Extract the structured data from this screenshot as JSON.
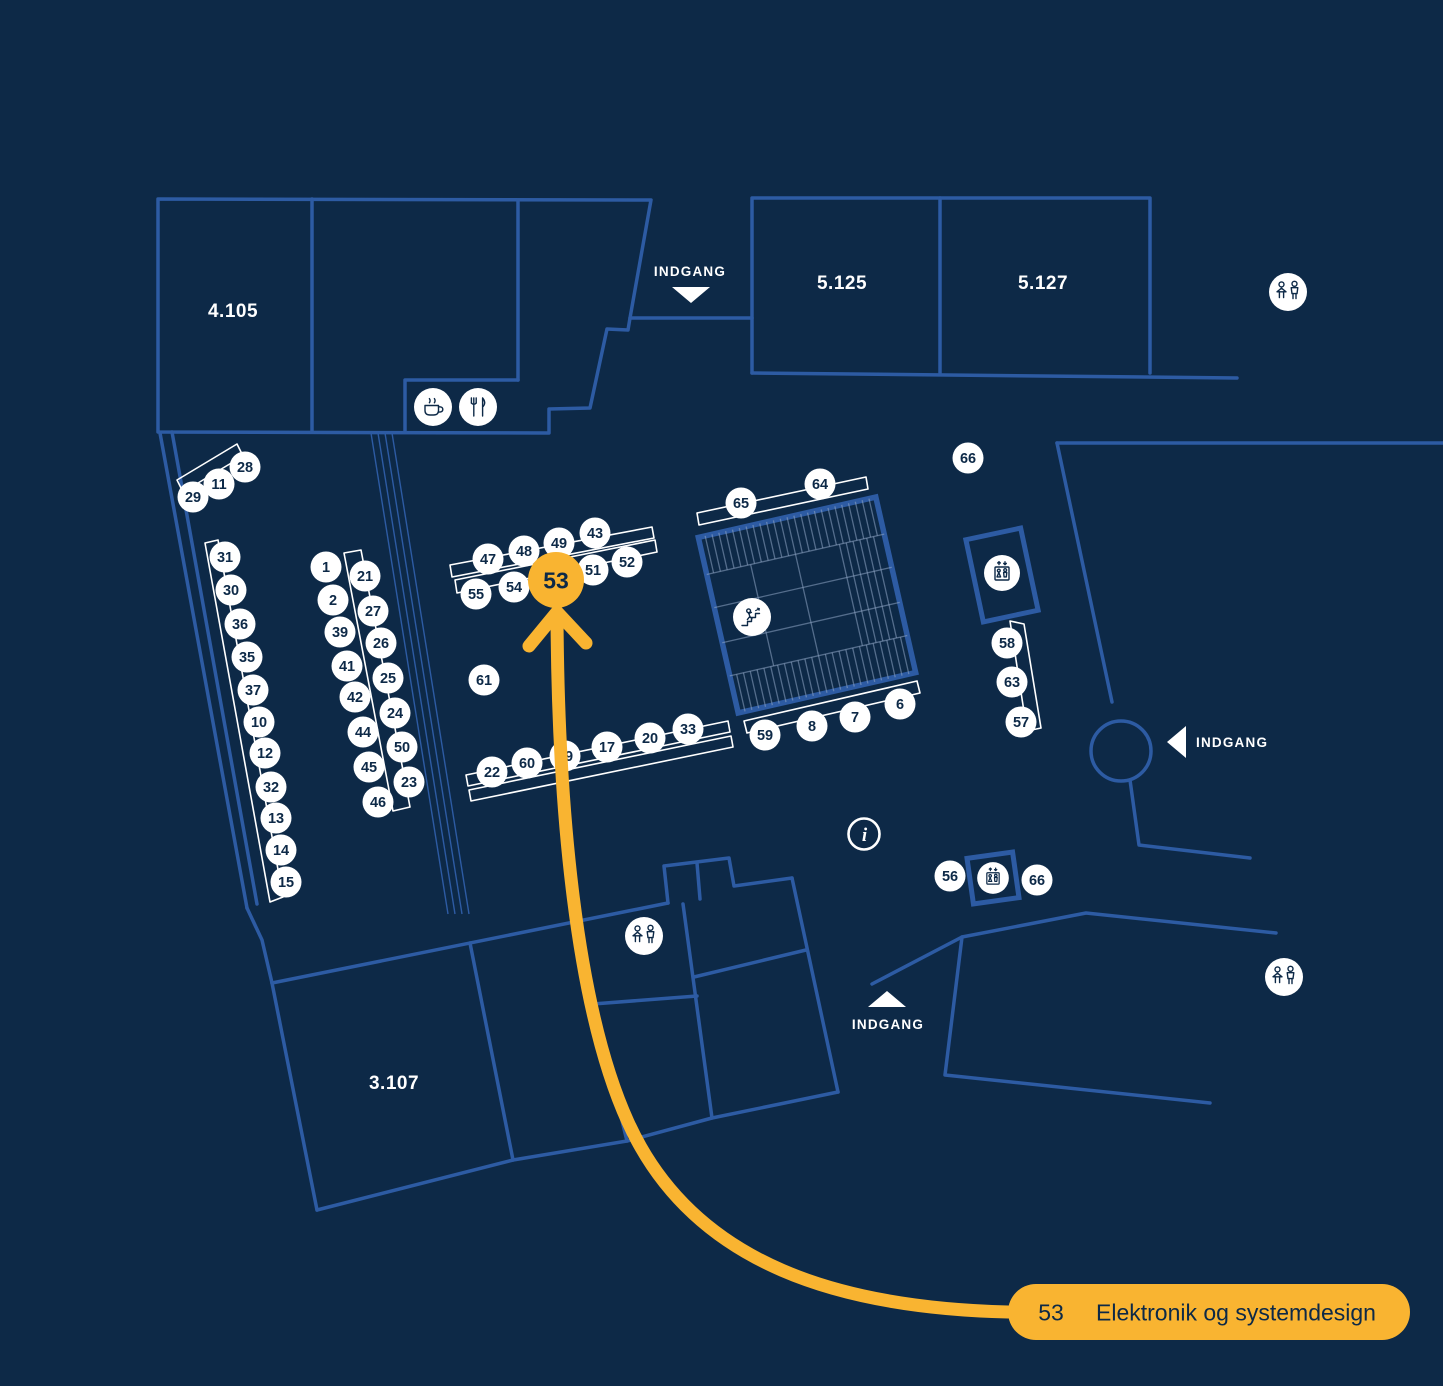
{
  "colors": {
    "background": "#0d2947",
    "line_blue": "#2d5ba3",
    "accent_orange": "#f9b431",
    "white": "#ffffff"
  },
  "legend": {
    "number": "53",
    "name": "Elektronik og systemdesign"
  },
  "highlight": {
    "number": "53",
    "x": 556,
    "y": 580
  },
  "rooms": [
    {
      "label": "4.105",
      "x": 233,
      "y": 310
    },
    {
      "label": "5.125",
      "x": 842,
      "y": 282
    },
    {
      "label": "5.127",
      "x": 1043,
      "y": 282
    },
    {
      "label": "3.107",
      "x": 394,
      "y": 1082
    }
  ],
  "entrances": [
    {
      "label": "INDGANG",
      "dir": "down",
      "tri": {
        "x": 691,
        "y": 295
      },
      "text": {
        "x": 690,
        "y": 271,
        "anchor": "middle"
      }
    },
    {
      "label": "INDGANG",
      "dir": "left",
      "tri": {
        "x": 1177,
        "y": 742
      },
      "text": {
        "x": 1196,
        "y": 742,
        "anchor": "start"
      }
    },
    {
      "label": "INDGANG",
      "dir": "up",
      "tri": {
        "x": 887,
        "y": 999
      },
      "text": {
        "x": 888,
        "y": 1024,
        "anchor": "middle"
      }
    }
  ],
  "markers": [
    {
      "n": "28",
      "x": 245,
      "y": 467
    },
    {
      "n": "11",
      "x": 219,
      "y": 484
    },
    {
      "n": "29",
      "x": 193,
      "y": 497
    },
    {
      "n": "31",
      "x": 225,
      "y": 557
    },
    {
      "n": "30",
      "x": 231,
      "y": 590
    },
    {
      "n": "36",
      "x": 240,
      "y": 624
    },
    {
      "n": "35",
      "x": 247,
      "y": 657
    },
    {
      "n": "37",
      "x": 253,
      "y": 690
    },
    {
      "n": "10",
      "x": 259,
      "y": 722
    },
    {
      "n": "12",
      "x": 265,
      "y": 753
    },
    {
      "n": "32",
      "x": 271,
      "y": 787
    },
    {
      "n": "13",
      "x": 276,
      "y": 818
    },
    {
      "n": "14",
      "x": 281,
      "y": 850
    },
    {
      "n": "15",
      "x": 286,
      "y": 882
    },
    {
      "n": "1",
      "x": 326,
      "y": 567
    },
    {
      "n": "2",
      "x": 333,
      "y": 600
    },
    {
      "n": "39",
      "x": 340,
      "y": 632
    },
    {
      "n": "41",
      "x": 347,
      "y": 666
    },
    {
      "n": "42",
      "x": 355,
      "y": 697
    },
    {
      "n": "44",
      "x": 363,
      "y": 732
    },
    {
      "n": "45",
      "x": 369,
      "y": 767
    },
    {
      "n": "46",
      "x": 378,
      "y": 802
    },
    {
      "n": "21",
      "x": 365,
      "y": 576
    },
    {
      "n": "27",
      "x": 373,
      "y": 611
    },
    {
      "n": "26",
      "x": 381,
      "y": 643
    },
    {
      "n": "25",
      "x": 388,
      "y": 678
    },
    {
      "n": "24",
      "x": 395,
      "y": 713
    },
    {
      "n": "50",
      "x": 402,
      "y": 747
    },
    {
      "n": "23",
      "x": 409,
      "y": 782
    },
    {
      "n": "47",
      "x": 488,
      "y": 559
    },
    {
      "n": "48",
      "x": 524,
      "y": 551
    },
    {
      "n": "49",
      "x": 559,
      "y": 543
    },
    {
      "n": "43",
      "x": 595,
      "y": 533
    },
    {
      "n": "55",
      "x": 476,
      "y": 594
    },
    {
      "n": "54",
      "x": 514,
      "y": 587
    },
    {
      "n": "51",
      "x": 593,
      "y": 570
    },
    {
      "n": "52",
      "x": 627,
      "y": 562
    },
    {
      "n": "65",
      "x": 741,
      "y": 503
    },
    {
      "n": "64",
      "x": 820,
      "y": 484
    },
    {
      "n": "66",
      "x": 968,
      "y": 458
    },
    {
      "n": "61",
      "x": 484,
      "y": 680
    },
    {
      "n": "22",
      "x": 492,
      "y": 772
    },
    {
      "n": "60",
      "x": 527,
      "y": 763
    },
    {
      "n": "19",
      "x": 565,
      "y": 756
    },
    {
      "n": "17",
      "x": 607,
      "y": 747
    },
    {
      "n": "20",
      "x": 650,
      "y": 738
    },
    {
      "n": "33",
      "x": 688,
      "y": 729
    },
    {
      "n": "59",
      "x": 765,
      "y": 735
    },
    {
      "n": "8",
      "x": 812,
      "y": 726
    },
    {
      "n": "7",
      "x": 855,
      "y": 717
    },
    {
      "n": "6",
      "x": 900,
      "y": 704
    },
    {
      "n": "58",
      "x": 1007,
      "y": 643
    },
    {
      "n": "63",
      "x": 1012,
      "y": 682
    },
    {
      "n": "57",
      "x": 1021,
      "y": 722
    },
    {
      "n": "56",
      "x": 950,
      "y": 876
    },
    {
      "n": "66",
      "x": 1037,
      "y": 880
    }
  ],
  "icons": [
    {
      "t": "coffee",
      "x": 433,
      "y": 407
    },
    {
      "t": "food",
      "x": 478,
      "y": 407
    },
    {
      "t": "wc",
      "x": 1288,
      "y": 292
    },
    {
      "t": "stairs",
      "x": 752,
      "y": 617
    },
    {
      "t": "lift",
      "x": 1002,
      "y": 573
    },
    {
      "t": "info",
      "x": 864,
      "y": 834
    },
    {
      "t": "lift",
      "x": 993,
      "y": 878,
      "s": 0.88
    },
    {
      "t": "wc",
      "x": 644,
      "y": 936
    },
    {
      "t": "wc",
      "x": 1284,
      "y": 977
    }
  ]
}
